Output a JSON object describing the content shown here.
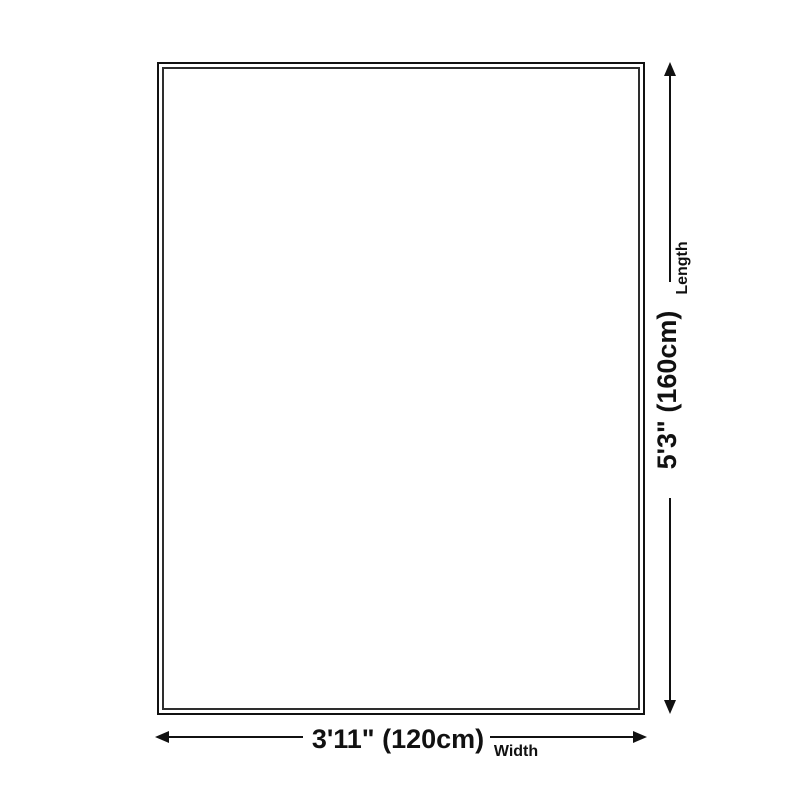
{
  "diagram": {
    "title": "rug-size-dimension-diagram",
    "background_color": "#ffffff",
    "outline_color": "#111111",
    "inner_outline_color": "#2e2e2e",
    "arrow_color": "#111111",
    "text_color": "#111111",
    "length": {
      "value": "5'3\" (160cm)",
      "label": "Length"
    },
    "width": {
      "value": "3'11\" (120cm)",
      "label": "Width"
    }
  }
}
